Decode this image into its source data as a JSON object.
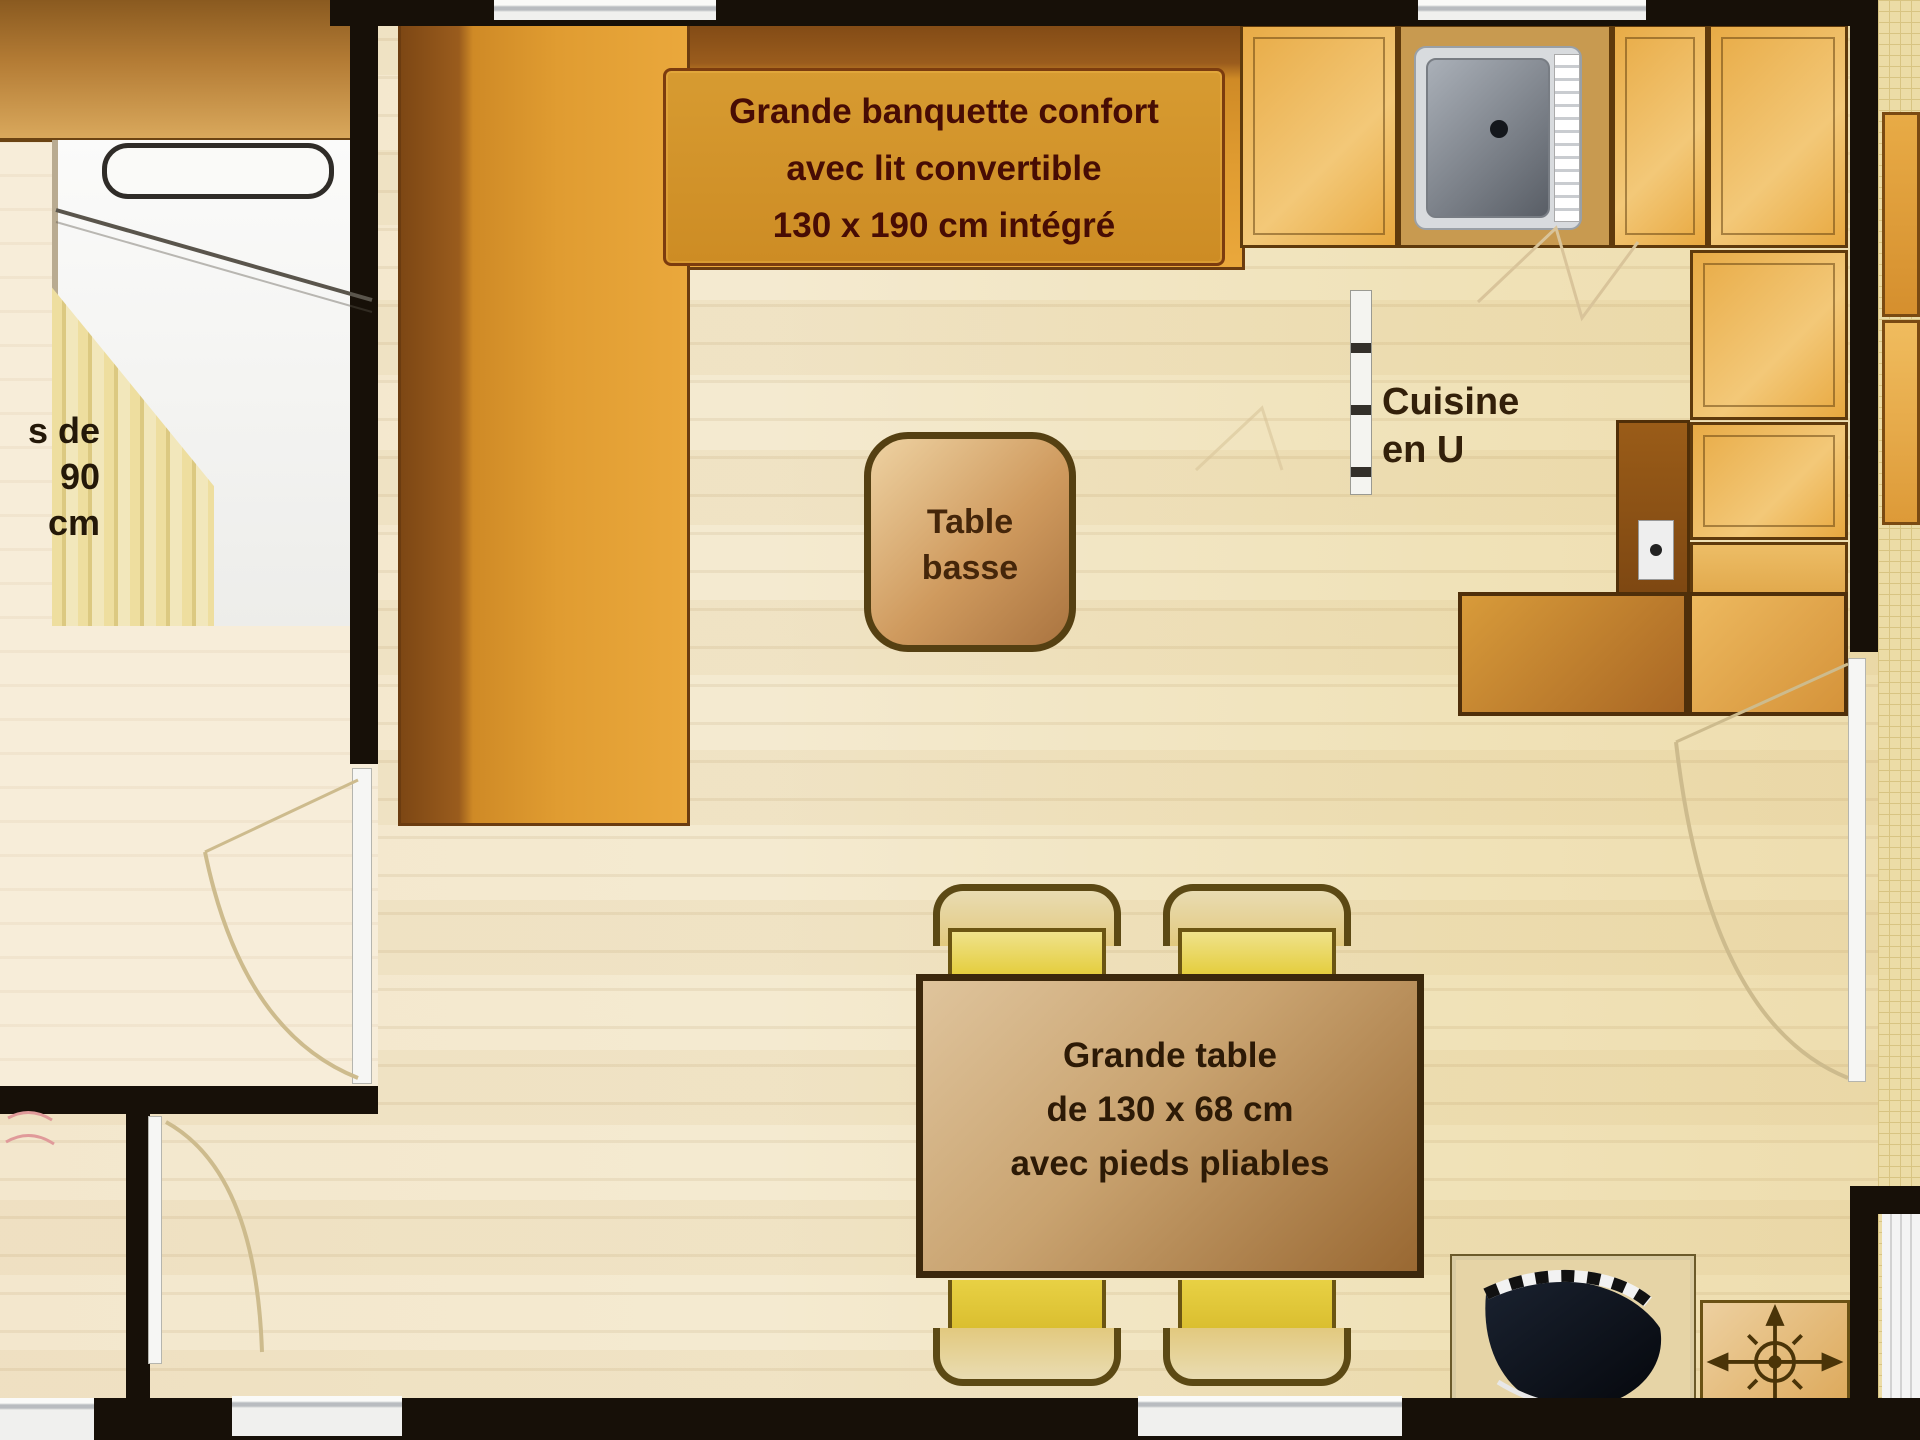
{
  "labels": {
    "banquette": {
      "line1": "Grande banquette confort",
      "line2": "avec lit convertible",
      "line3": "130 x 190 cm intégré"
    },
    "bed_fragment": {
      "line1": "s de",
      "line2": "90 cm"
    },
    "kitchen": {
      "line1": "Cuisine",
      "line2": "en U"
    },
    "coffee_table": {
      "line1": "Table",
      "line2": "basse"
    },
    "dining_table": {
      "line1": "Grande table",
      "line2": "de 130 x 68 cm",
      "line3": "avec pieds pliables"
    }
  },
  "icons": {
    "sink_drain": "drain-dot",
    "heater": "compass-crosshair",
    "corner_unit": "dark-bowl-with-checker-strip",
    "doors": "door-swing-arc"
  },
  "colors": {
    "wall": "#171008",
    "floor_a": "#f3e7cd",
    "floor_b": "#eeddae",
    "bedroom_floor": "#f7edd9",
    "banquette_back": "#7d4714",
    "banquette_seat": "#e09c31",
    "label_box": "#cd8c24",
    "label_box_border": "#7c3c0e",
    "label_text": "#470c04",
    "cabinet_border": "#5f3a0c",
    "cabinet_a": "#e8ab46",
    "cabinet_b": "#f3c878",
    "sink_frame": "#d8dbde",
    "sink_a": "#aab0b8",
    "sink_b": "#595e66",
    "drain": "#14171c",
    "counter_a": "#d89b3a",
    "counter_b": "#a96724",
    "chair_yellow": "#e3cb33",
    "chair_outline": "#6b5512",
    "chair_back": "#5c4914",
    "table_border": "#3c280c",
    "table_a": "#dfc49c",
    "table_b": "#996832",
    "table_text": "#2d1a06",
    "coffee_border": "#554012",
    "coffee_a": "#eed2a2",
    "coffee_b": "#aa7440",
    "coffee_text": "#45260a",
    "kitchen_text": "#33200a",
    "bed_text": "#241808",
    "window": "#f2f2f0",
    "arc": "#cdbb8d",
    "terrace": "#ecdca6",
    "terrace_line": "#d8c482",
    "bowl_a": "#1a2230",
    "bowl_b": "#05070c",
    "heater_a": "#edd0a0",
    "heater_b": "#dca757",
    "compass": "#4a3408"
  }
}
